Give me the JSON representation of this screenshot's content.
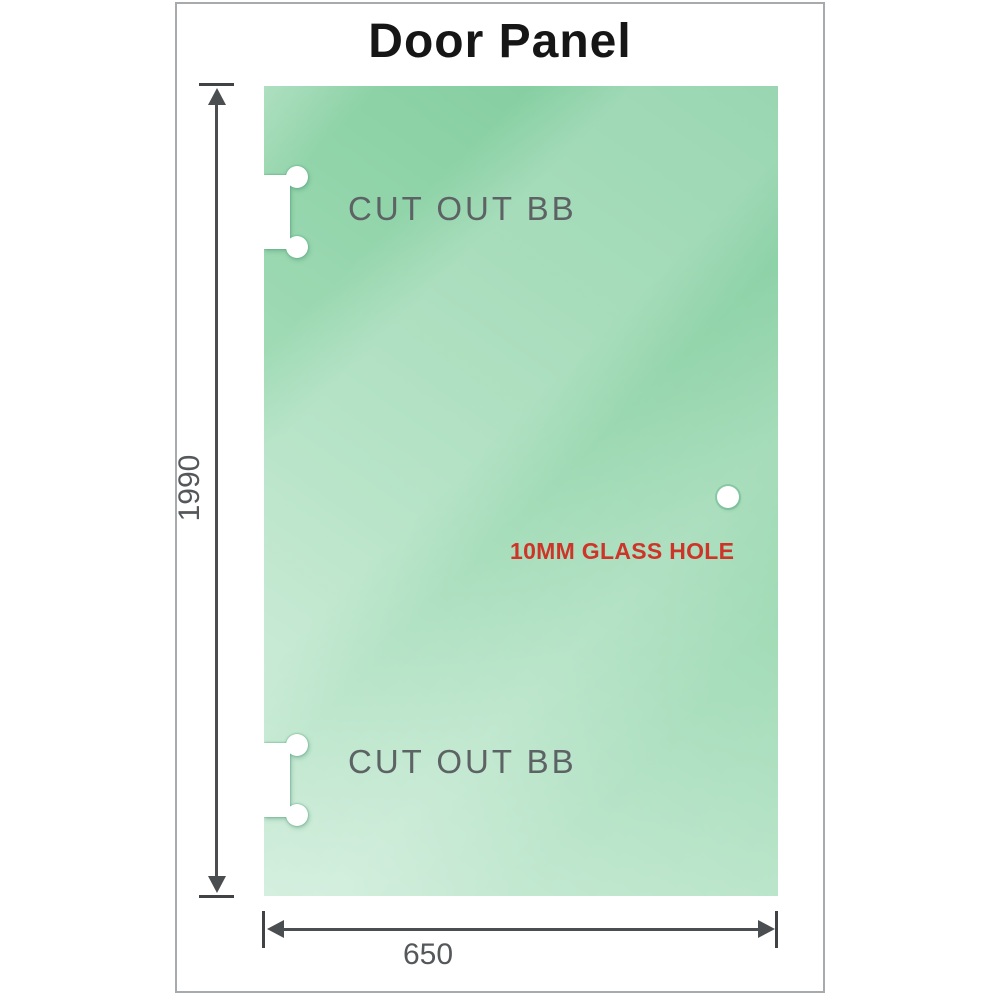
{
  "title": "Door Panel",
  "panel": {
    "cutout_top_label": "CUT OUT BB",
    "cutout_bottom_label": "CUT OUT BB",
    "hole_label": "10MM GLASS HOLE"
  },
  "dimensions": {
    "height_label": "1990",
    "width_label": "650"
  },
  "colors": {
    "glass_green_dark": "#7ecb9d",
    "glass_green_light": "#cdecd9",
    "hole_label_red": "#cd3529",
    "dimension_gray": "#4a4e50",
    "cutout_label_gray": "#5d6365",
    "frame_border_gray": "#a8abad"
  }
}
